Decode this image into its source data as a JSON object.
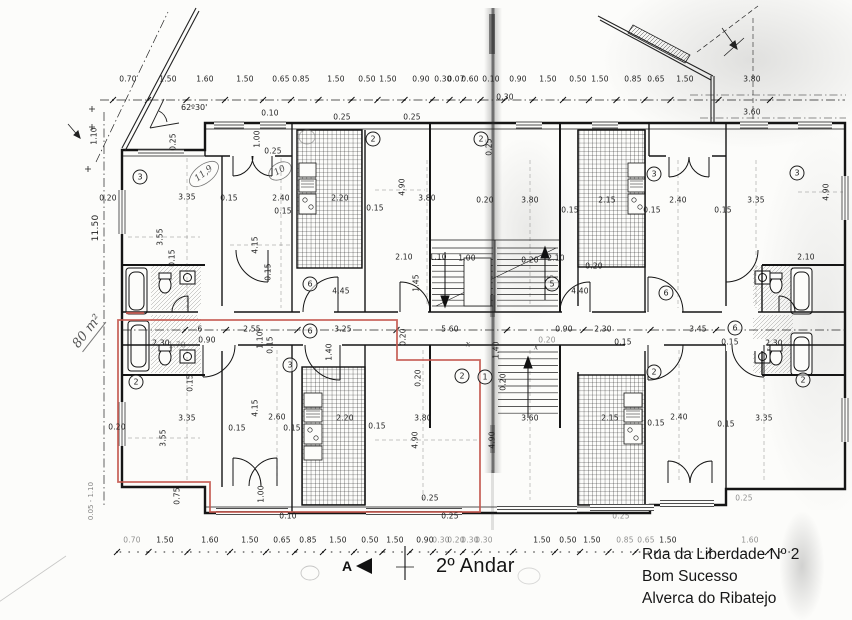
{
  "meta": {
    "floor_title": "2º Andar"
  },
  "address": {
    "line1": "Rua da Liberdade Nº 2",
    "line2": "Bom Sucesso",
    "line3": "Alverca do Ribatejo"
  },
  "notes": {
    "area": "80 m²",
    "angle": "62º30'",
    "section": "A",
    "total_height": "11.50",
    "left_small": "0.05 - 1.10"
  },
  "colors": {
    "highlight": "#c4564c",
    "ink": "#1d1d1d",
    "paper": "#fcfcfa"
  },
  "chains": {
    "top": {
      "y": 79,
      "line_y": 100,
      "items": [
        {
          "v": "0.70",
          "x": 128
        },
        {
          "v": "1.50",
          "x": 168
        },
        {
          "v": "1.60",
          "x": 205
        },
        {
          "v": "1.50",
          "x": 245
        },
        {
          "v": "0.65",
          "x": 281
        },
        {
          "v": "0.85",
          "x": 301
        },
        {
          "v": "1.50",
          "x": 336
        },
        {
          "v": "0.50",
          "x": 367
        },
        {
          "v": "1.50",
          "x": 388
        },
        {
          "v": "0.90",
          "x": 421
        },
        {
          "v": "0.30",
          "x": 443
        },
        {
          "v": "0.07",
          "x": 456
        },
        {
          "v": "0.60",
          "x": 470
        },
        {
          "v": "0.10",
          "x": 491
        },
        {
          "v": "0.90",
          "x": 518
        },
        {
          "v": "1.50",
          "x": 548
        },
        {
          "v": "0.50",
          "x": 578
        },
        {
          "v": "1.50",
          "x": 600
        },
        {
          "v": "0.85",
          "x": 633
        },
        {
          "v": "0.65",
          "x": 656
        },
        {
          "v": "1.50",
          "x": 685
        },
        {
          "v": "3.80",
          "x": 752
        }
      ]
    },
    "top2": {
      "y": 112,
      "line_y": 118,
      "items": [
        {
          "v": "3.60",
          "x": 752
        }
      ]
    },
    "bottom": {
      "y": 540,
      "line_y": 552,
      "items": [
        {
          "v": "0.70",
          "x": 132,
          "f": 1
        },
        {
          "v": "1.50",
          "x": 165
        },
        {
          "v": "1.60",
          "x": 210
        },
        {
          "v": "1.50",
          "x": 250
        },
        {
          "v": "0.65",
          "x": 282
        },
        {
          "v": "0.85",
          "x": 308
        },
        {
          "v": "1.50",
          "x": 338
        },
        {
          "v": "0.50",
          "x": 370
        },
        {
          "v": "1.50",
          "x": 395
        },
        {
          "v": "0.90",
          "x": 425
        },
        {
          "v": "0.30",
          "x": 441,
          "f": 1
        },
        {
          "v": "0.20",
          "x": 456,
          "f": 1
        },
        {
          "v": "0.30",
          "x": 470,
          "f": 1
        },
        {
          "v": "0.30",
          "x": 484,
          "f": 1
        },
        {
          "v": "1.50",
          "x": 542
        },
        {
          "v": "0.50",
          "x": 568
        },
        {
          "v": "1.50",
          "x": 592
        },
        {
          "v": "0.85",
          "x": 625,
          "f": 1
        },
        {
          "v": "0.65",
          "x": 646,
          "f": 1
        },
        {
          "v": "1.50",
          "x": 668
        },
        {
          "v": "1.60",
          "x": 750,
          "f": 1
        }
      ]
    },
    "middle": {
      "y": 329,
      "line_y": 330,
      "items": [
        {
          "v": "6",
          "x": 200
        },
        {
          "v": "2.55",
          "x": 252
        },
        {
          "v": "3.25",
          "x": 343
        },
        {
          "v": "5 60",
          "x": 450
        },
        {
          "v": "0.90",
          "x": 564
        },
        {
          "v": "2.30",
          "x": 603
        },
        {
          "v": "3.45",
          "x": 698
        }
      ]
    }
  },
  "dims": [
    {
      "t": "0.20",
      "x": 108,
      "y": 198
    },
    {
      "t": "1.10",
      "x": 94,
      "y": 136,
      "r": 1
    },
    {
      "t": "0.25",
      "x": 173,
      "y": 142,
      "r": 1
    },
    {
      "t": "3.35",
      "x": 187,
      "y": 197
    },
    {
      "t": "0.15",
      "x": 229,
      "y": 198
    },
    {
      "t": "2.40",
      "x": 281,
      "y": 198
    },
    {
      "t": "0.15",
      "x": 283,
      "y": 211
    },
    {
      "t": "3.55",
      "x": 160,
      "y": 237,
      "r": 1
    },
    {
      "t": "0.15",
      "x": 172,
      "y": 258,
      "r": 1
    },
    {
      "t": "4.15",
      "x": 255,
      "y": 245,
      "r": 1
    },
    {
      "t": "0.15",
      "x": 268,
      "y": 272,
      "r": 1
    },
    {
      "t": "0.10",
      "x": 270,
      "y": 113
    },
    {
      "t": "1.00",
      "x": 257,
      "y": 139,
      "r": 1
    },
    {
      "t": "0.25",
      "x": 273,
      "y": 151
    },
    {
      "t": "2.20",
      "x": 340,
      "y": 198
    },
    {
      "t": "0.15",
      "x": 375,
      "y": 208
    },
    {
      "t": "4.90",
      "x": 402,
      "y": 187,
      "r": 1
    },
    {
      "t": "2.10",
      "x": 404,
      "y": 257
    },
    {
      "t": "1.45",
      "x": 416,
      "y": 283,
      "r": 1
    },
    {
      "t": "4.45",
      "x": 341,
      "y": 291
    },
    {
      "t": "1.10",
      "x": 438,
      "y": 257
    },
    {
      "t": "1.00",
      "x": 467,
      "y": 258
    },
    {
      "t": "0.20",
      "x": 530,
      "y": 260
    },
    {
      "t": "2.10",
      "x": 556,
      "y": 258
    },
    {
      "t": "3.80",
      "x": 427,
      "y": 198
    },
    {
      "t": "0.20",
      "x": 485,
      "y": 200
    },
    {
      "t": "3.80",
      "x": 530,
      "y": 200
    },
    {
      "t": "0.25",
      "x": 489,
      "y": 147,
      "r": 1
    },
    {
      "t": "0.30",
      "x": 505,
      "y": 97
    },
    {
      "t": "2.15",
      "x": 607,
      "y": 200
    },
    {
      "t": "0.15",
      "x": 570,
      "y": 210
    },
    {
      "t": "2.40",
      "x": 678,
      "y": 200
    },
    {
      "t": "0.15",
      "x": 652,
      "y": 210
    },
    {
      "t": "3.35",
      "x": 756,
      "y": 200
    },
    {
      "t": "0.15",
      "x": 723,
      "y": 210
    },
    {
      "t": "4.90",
      "x": 826,
      "y": 192,
      "r": 1
    },
    {
      "t": "2.10",
      "x": 806,
      "y": 257
    },
    {
      "t": "4.40",
      "x": 580,
      "y": 291
    },
    {
      "t": "0.20",
      "x": 594,
      "y": 266
    },
    {
      "t": "1.45",
      "x": 551,
      "y": 283,
      "r": 1,
      "f": 1
    },
    {
      "t": "0.90",
      "x": 207,
      "y": 340
    },
    {
      "t": "2.30",
      "x": 161,
      "y": 343
    },
    {
      "t": "1.70",
      "x": 177,
      "y": 345,
      "f": 1
    },
    {
      "t": "1.10",
      "x": 260,
      "y": 340,
      "r": 1
    },
    {
      "t": "0.15",
      "x": 270,
      "y": 345,
      "r": 1
    },
    {
      "t": "1.40",
      "x": 329,
      "y": 352,
      "r": 1
    },
    {
      "t": "0.20",
      "x": 403,
      "y": 337,
      "r": 1
    },
    {
      "t": "1.40",
      "x": 496,
      "y": 350,
      "r": 1
    },
    {
      "t": "0.15",
      "x": 623,
      "y": 342
    },
    {
      "t": "0.15",
      "x": 730,
      "y": 342
    },
    {
      "t": "2.30",
      "x": 774,
      "y": 343
    },
    {
      "t": "0.20",
      "x": 547,
      "y": 340,
      "f": 1
    },
    {
      "t": "0.15",
      "x": 190,
      "y": 383,
      "r": 1
    },
    {
      "t": "3.35",
      "x": 187,
      "y": 418
    },
    {
      "t": "3.55",
      "x": 163,
      "y": 438,
      "r": 1
    },
    {
      "t": "0.20",
      "x": 117,
      "y": 427
    },
    {
      "t": "4.15",
      "x": 255,
      "y": 408,
      "r": 1
    },
    {
      "t": "2.60",
      "x": 277,
      "y": 417
    },
    {
      "t": "0.15",
      "x": 237,
      "y": 428
    },
    {
      "t": "0.15",
      "x": 292,
      "y": 428
    },
    {
      "t": "2.20",
      "x": 345,
      "y": 418
    },
    {
      "t": "0.15",
      "x": 377,
      "y": 426
    },
    {
      "t": "3.80",
      "x": 423,
      "y": 418
    },
    {
      "t": "4.90",
      "x": 415,
      "y": 440,
      "r": 1
    },
    {
      "t": "0.20",
      "x": 418,
      "y": 378,
      "r": 1
    },
    {
      "t": "1.00",
      "x": 261,
      "y": 494,
      "r": 1
    },
    {
      "t": "0.75",
      "x": 177,
      "y": 496,
      "r": 1
    },
    {
      "t": "0.10",
      "x": 288,
      "y": 516
    },
    {
      "t": "0.25",
      "x": 430,
      "y": 498
    },
    {
      "t": "0.25",
      "x": 450,
      "y": 516
    },
    {
      "t": "3.60",
      "x": 530,
      "y": 418
    },
    {
      "t": "2.15",
      "x": 610,
      "y": 418
    },
    {
      "t": "0.15",
      "x": 656,
      "y": 423
    },
    {
      "t": "2.40",
      "x": 679,
      "y": 417
    },
    {
      "t": "0.15",
      "x": 726,
      "y": 424
    },
    {
      "t": "3.35",
      "x": 764,
      "y": 418
    },
    {
      "t": "4.90",
      "x": 492,
      "y": 440,
      "r": 1
    },
    {
      "t": "0.20",
      "x": 503,
      "y": 382,
      "r": 1
    },
    {
      "t": "0.25",
      "x": 744,
      "y": 498,
      "f": 1
    },
    {
      "t": "0.25",
      "x": 621,
      "y": 516,
      "f": 1
    },
    {
      "t": "0.25",
      "x": 342,
      "y": 117
    },
    {
      "t": "0.25",
      "x": 412,
      "y": 117
    }
  ],
  "circles": [
    {
      "n": "3",
      "x": 140,
      "y": 177
    },
    {
      "n": "2",
      "x": 373,
      "y": 139
    },
    {
      "n": "2",
      "x": 481,
      "y": 139
    },
    {
      "n": "3",
      "x": 654,
      "y": 174
    },
    {
      "n": "3",
      "x": 797,
      "y": 173
    },
    {
      "n": "6",
      "x": 310,
      "y": 284
    },
    {
      "n": "5",
      "x": 552,
      "y": 284
    },
    {
      "n": "6",
      "x": 666,
      "y": 293
    },
    {
      "n": "6",
      "x": 310,
      "y": 331
    },
    {
      "n": "6",
      "x": 735,
      "y": 328
    },
    {
      "n": "2",
      "x": 136,
      "y": 382
    },
    {
      "n": "3",
      "x": 290,
      "y": 365
    },
    {
      "n": "2",
      "x": 462,
      "y": 376
    },
    {
      "n": "1",
      "x": 485,
      "y": 377
    },
    {
      "n": "2",
      "x": 654,
      "y": 372
    },
    {
      "n": "2",
      "x": 803,
      "y": 380
    }
  ],
  "hand": [
    {
      "t": "11,9",
      "x": 204,
      "y": 174,
      "r": -38,
      "s": 9
    },
    {
      "t": "10",
      "x": 280,
      "y": 171,
      "r": -30,
      "s": 9
    },
    {
      "t": "x",
      "x": 468,
      "y": 344,
      "r": 0,
      "s": 8
    },
    {
      "t": "x",
      "x": 536,
      "y": 347,
      "r": 0,
      "s": 8
    }
  ]
}
